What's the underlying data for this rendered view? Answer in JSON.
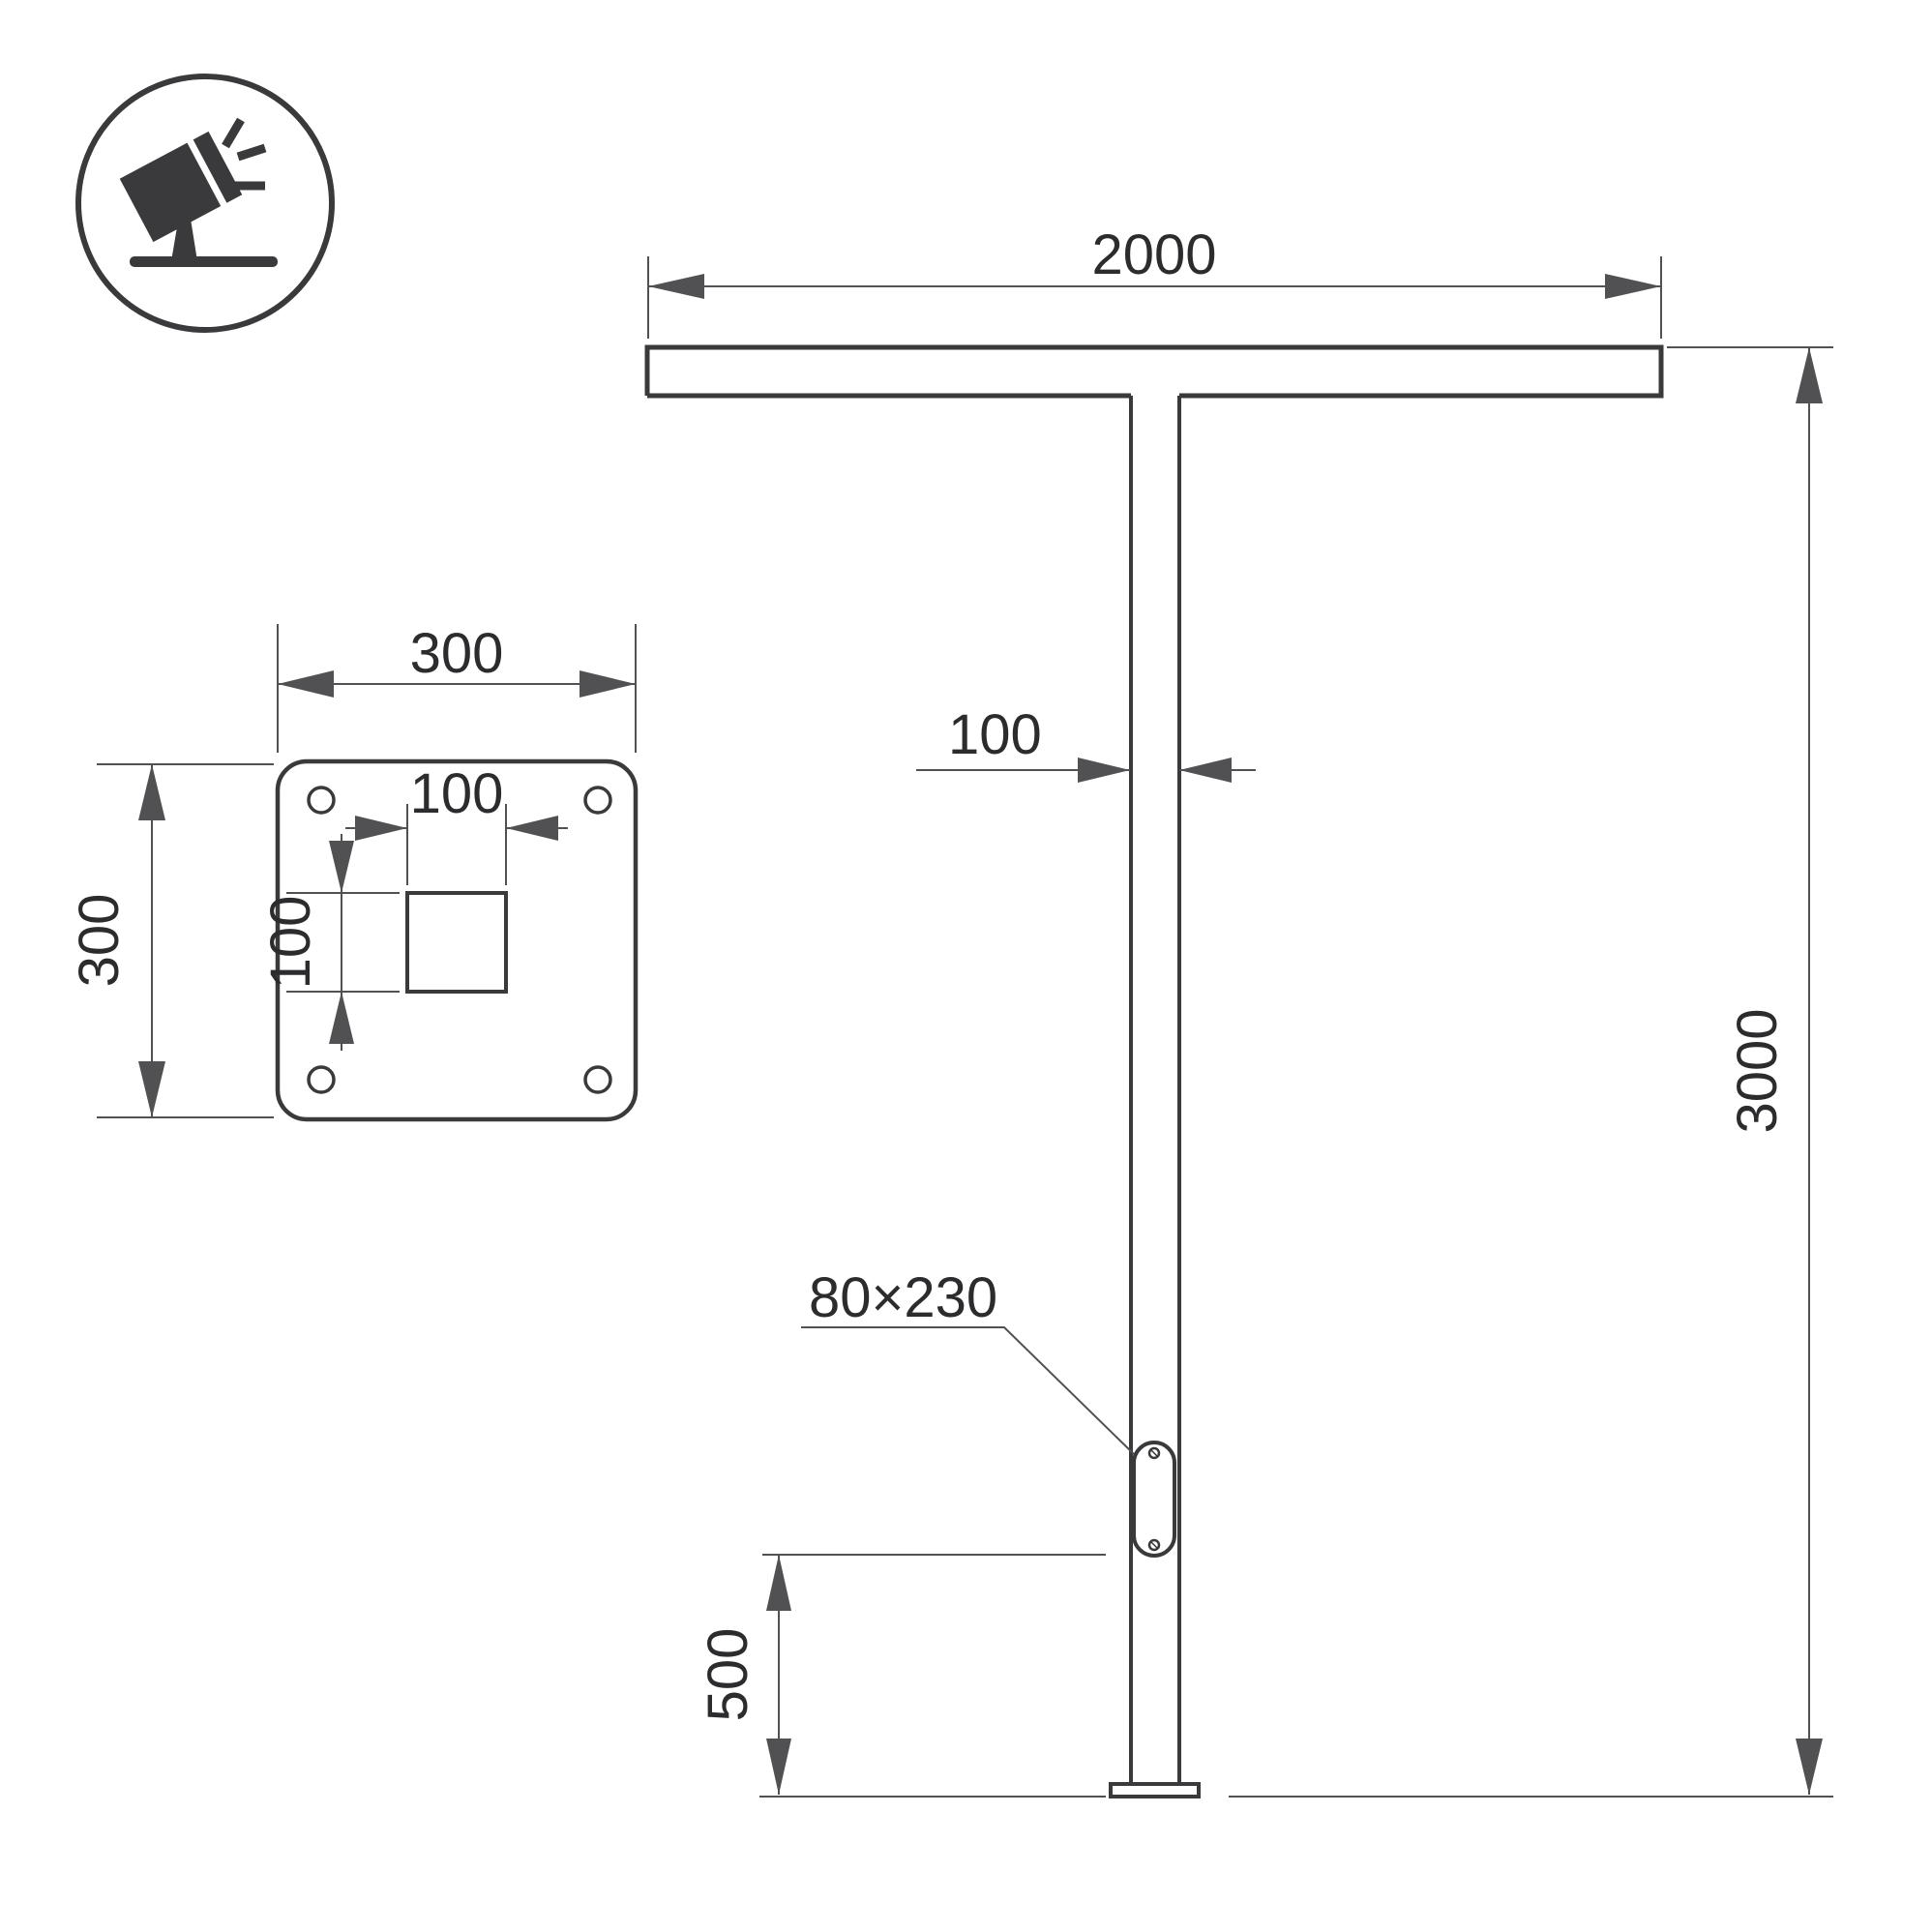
{
  "colors": {
    "line": "#3a3a3c",
    "dim": "#515154",
    "text": "#2c2c2e",
    "bg": "#ffffff"
  },
  "views": {
    "front": {
      "span": "2000",
      "height": "3000",
      "pole_width": "100",
      "hatch_size": "80×230",
      "hatch_bottom_offset": "500"
    },
    "base_plate": {
      "width": "300",
      "height": "300",
      "cutout_width": "100",
      "cutout_height": "100"
    }
  }
}
